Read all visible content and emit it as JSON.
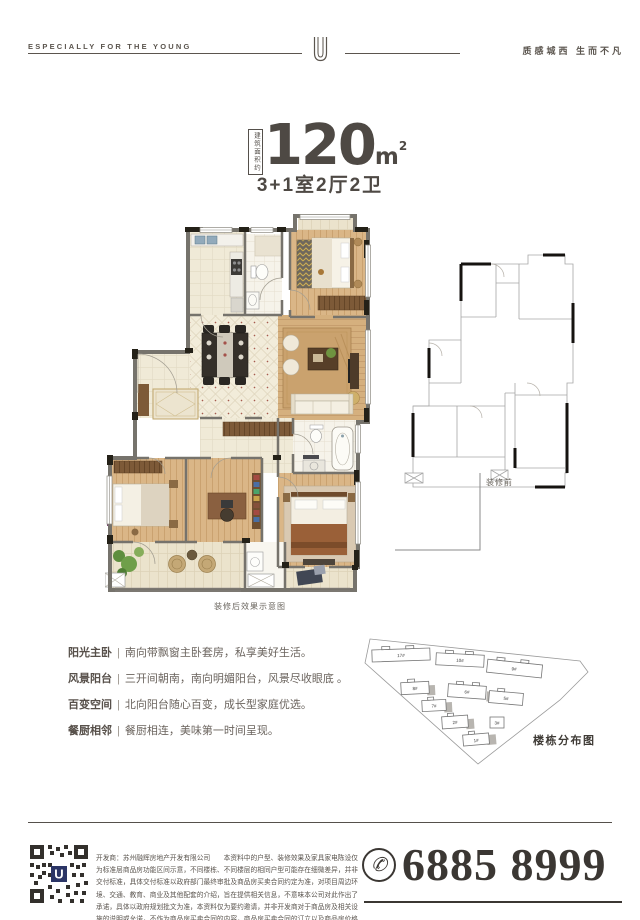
{
  "header": {
    "left_text": "ESPECIALLY FOR THE YOUNG",
    "right_text": "质感城西 生而不凡",
    "logo": "U"
  },
  "title": {
    "area_label": "建筑面积约",
    "value": "120",
    "unit": "m",
    "unit_sup": "2",
    "layout": "3+1室2厅2卫"
  },
  "plans": {
    "after_caption": "装修后效果示意图",
    "before_caption": "装修前"
  },
  "features_separator": "|",
  "features": [
    {
      "title": "阳光主卧",
      "desc": "南向带飘窗主卧套房，私享美好生活。"
    },
    {
      "title": "风景阳台",
      "desc": "三开间朝南，南向明媚阳台，风景尽收眼底 。"
    },
    {
      "title": "百变空间",
      "desc": "北向阳台随心百变，成长型家庭优选。"
    },
    {
      "title": "餐厨相邻",
      "desc": "餐厨相连，美味第一时间呈现。"
    }
  ],
  "sitemap": {
    "caption": "楼栋分布图",
    "buildings": [
      "17#",
      "10#",
      "9#",
      "8#",
      "6#",
      "5#",
      "7#",
      "2#",
      "3#",
      "1#"
    ]
  },
  "footer": {
    "disclaimer": "开发商：苏州融辉房地产开发有限公司　　本资料中的户型、装修效果及家具家电陈设仅为标准层商品房功能区间示意，不同楼栋、不同楼层的相同户型可能存在细微差异，并非交付标准，具体交付标准以政府部门最终审批及商品房买卖合同约定为准，对项目周边环境、交通、教育、商业及其他配套的介绍，旨在提供相关信息，不意味本公司对此作出了承诺，具体以政府规划批文为准，本资料仅为要约邀请，并非开发商对于商品房及相关设施的说明或允诺，不作为商品房买卖合同的内容，商品房买卖合同的订立以及商品房价格的确定仅以现场销售结果为准。刊印日期：2018年8月",
    "phone_icon": "✆",
    "phone": "6885 8999",
    "qr_logo": "U"
  },
  "colors": {
    "ink": "#55504b",
    "phone_ink": "#3b3733",
    "wood": "#d8b283",
    "tile": "#f0ead7"
  }
}
